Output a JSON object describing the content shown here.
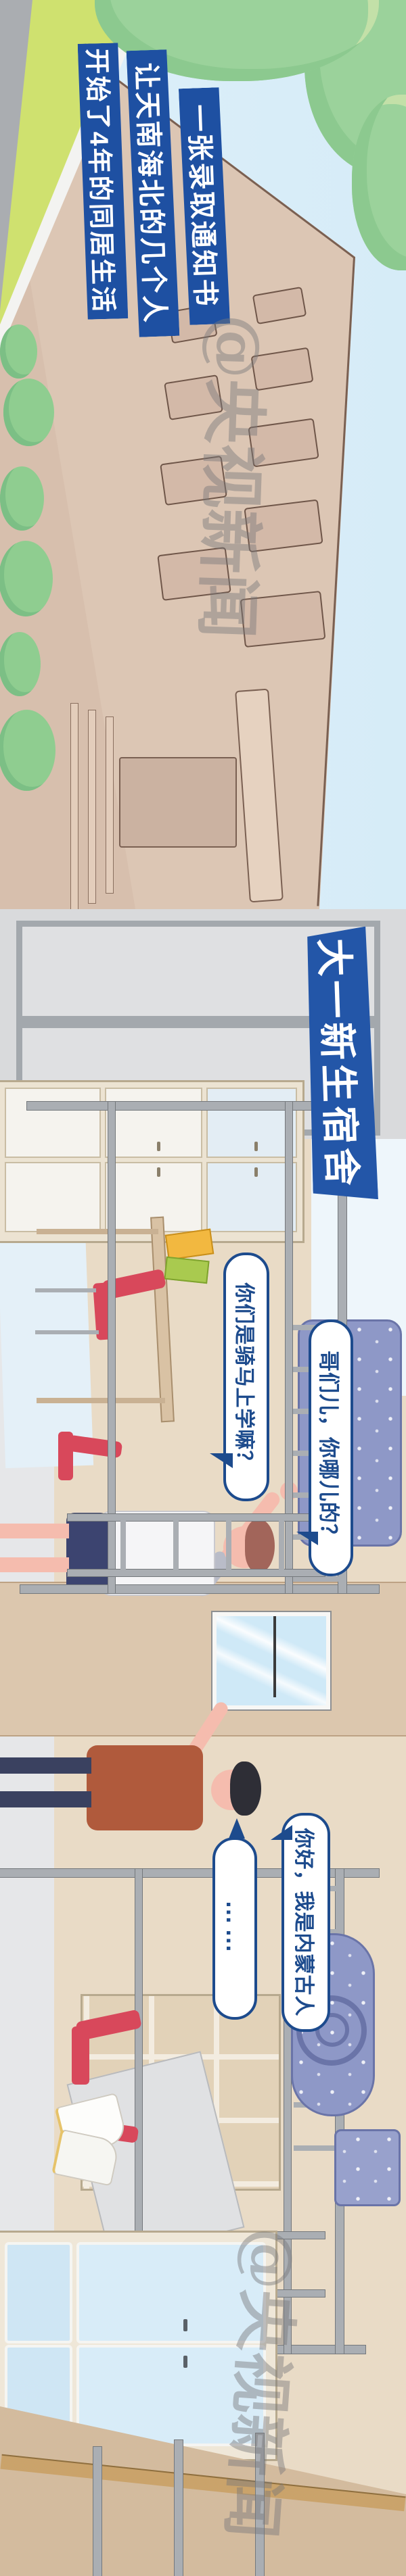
{
  "watermark": {
    "handle": "@央视新闻",
    "logo": "cctv-news-circle-logo"
  },
  "intro_banners": [
    {
      "label": "一张录取通知书"
    },
    {
      "label": "让天南海北的几个人"
    },
    {
      "label": "开始了4年的同居生活"
    }
  ],
  "room_banner": {
    "label": "大一新生宿舍"
  },
  "dialogue": {
    "where_from": "哥们儿，你哪儿的？",
    "ride_horse": "你们是骑马上学嘛？",
    "inner_mongolia": "你好，我是内蒙古人",
    "ellipsis": "……"
  },
  "colors": {
    "banner_blue": "#1e50a2",
    "bubble_navy": "#1d4b8d",
    "chair_red": "#d8485b",
    "bedding_blue": "#8e98c7",
    "wall_beige": "#e9dbc6",
    "facade_tan": "#dcc6b4",
    "sky_blue": "#d6ecf7",
    "grass_lime": "#cfe16f",
    "tree_green": "#9bd29b",
    "road_gray": "#aaadb1",
    "metal_gray": "#aaaeb3"
  }
}
